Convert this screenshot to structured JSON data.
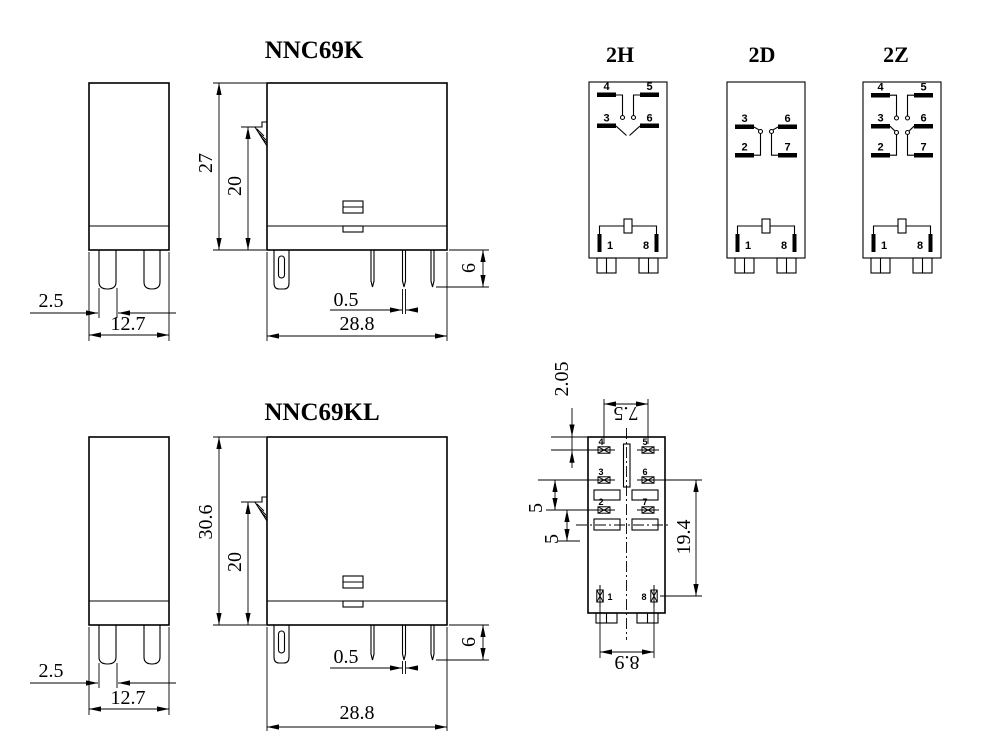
{
  "page": {
    "background": "#ffffff",
    "line_color": "#000000"
  },
  "models": {
    "nnc69k": {
      "title": "NNC69K",
      "dims": {
        "pin_width": "2.5",
        "side_width": "12.7",
        "total_height": "27",
        "body_height": "20",
        "pin_length": "6",
        "pin_thickness": "0.5",
        "front_width": "28.8"
      }
    },
    "nnc69kl": {
      "title": "NNC69KL",
      "dims": {
        "pin_width": "2.5",
        "side_width": "12.7",
        "total_height": "30.6",
        "body_height": "20",
        "pin_length": "6",
        "pin_thickness": "0.5",
        "front_width": "28.8"
      }
    }
  },
  "wiring_diagrams": [
    {
      "label": "2H",
      "pins": {
        "p4": "4",
        "p5": "5",
        "p3": "3",
        "p6": "6",
        "p1": "1",
        "p8": "8"
      }
    },
    {
      "label": "2D",
      "pins": {
        "p3": "3",
        "p6": "6",
        "p2": "2",
        "p7": "7",
        "p1": "1",
        "p8": "8"
      }
    },
    {
      "label": "2Z",
      "pins": {
        "p4": "4",
        "p5": "5",
        "p3": "3",
        "p6": "6",
        "p2": "2",
        "p7": "7",
        "p1": "1",
        "p8": "8"
      }
    }
  ],
  "bottom_view": {
    "pins": {
      "p1": "1",
      "p2": "2",
      "p3": "3",
      "p4": "4",
      "p5": "5",
      "p6": "6",
      "p7": "7",
      "p8": "8"
    },
    "dims": {
      "top_edge_to_first_row": "2.05",
      "top_row_pitch": "7.5",
      "row_gap_a": "5",
      "row_gap_b": "5",
      "contact_field_height": "19.4",
      "coil_row_pitch": "8.9"
    }
  }
}
